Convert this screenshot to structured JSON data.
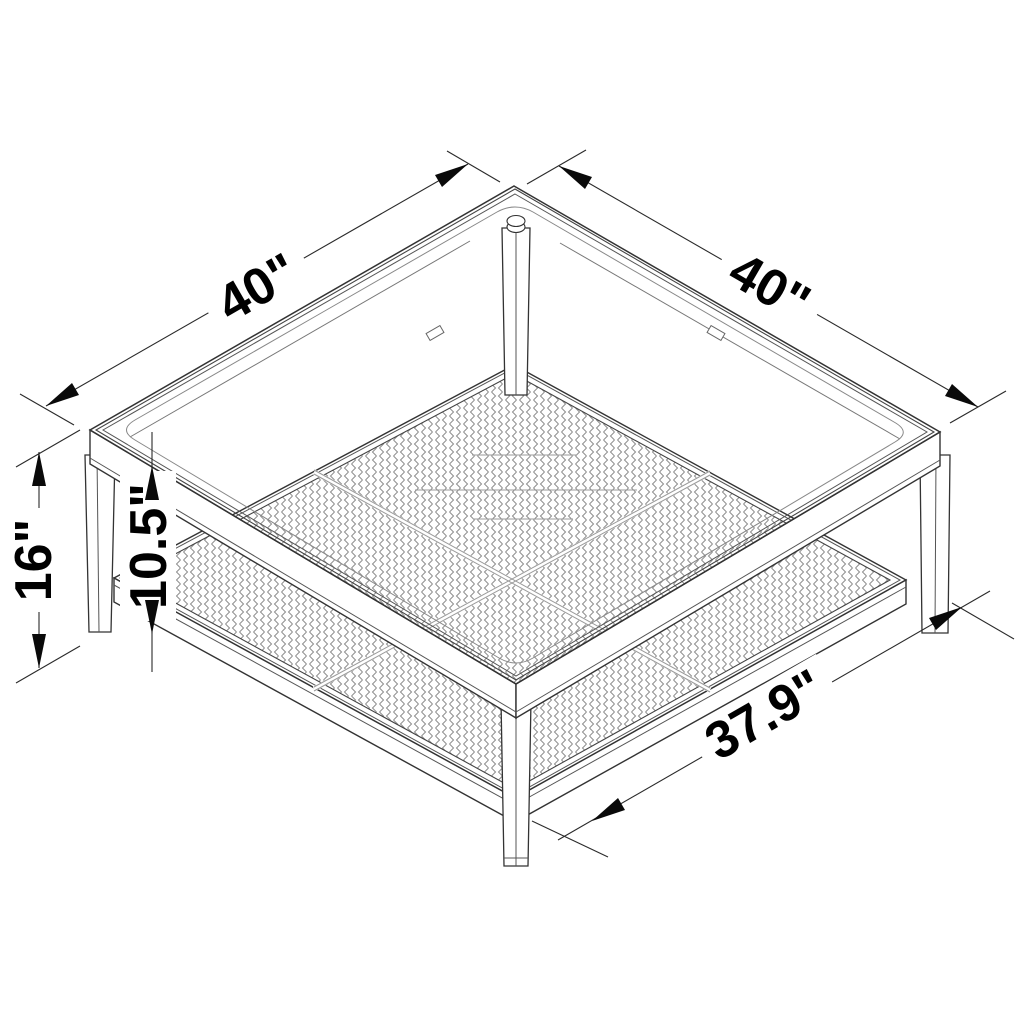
{
  "diagram": {
    "name": "Square coffee table with glass top and woven shelf — dimension drawing",
    "labels": {
      "top_left_edge": "40\"",
      "top_right_edge": "40\"",
      "overall_height": "16\"",
      "shelf_clearance": "10.5\"",
      "shelf_width": "37.9\""
    },
    "colors": {
      "background": "#ffffff",
      "structure_line": "#333333",
      "light_line": "#9a9a9a",
      "pattern_line": "#8d8d8d",
      "dimension_line": "#2a2a2a",
      "arrow_fill": "#0a0a0a",
      "text": "#000000"
    }
  }
}
